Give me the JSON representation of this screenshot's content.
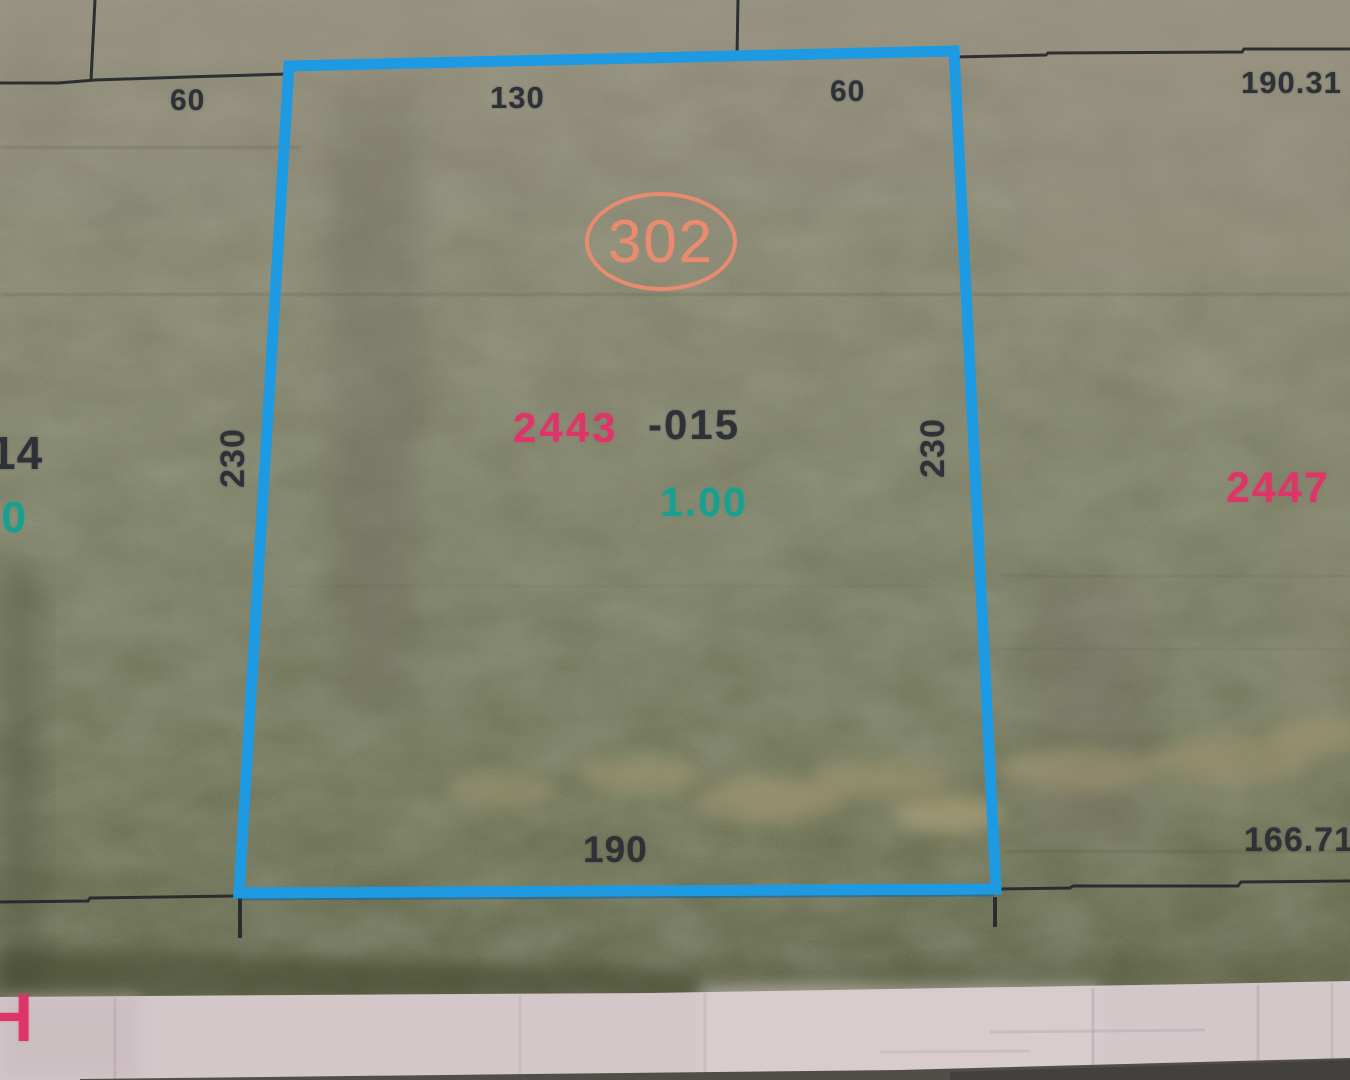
{
  "map": {
    "parcel": {
      "circle_number": "302",
      "book_id": "2443",
      "parcel_suffix": "-015",
      "acreage": "1.00",
      "dim_top": "130",
      "dim_left": "230",
      "dim_right": "230",
      "dim_bottom": "190"
    },
    "adjacent_labels": {
      "top_left_60": "60",
      "top_right_60": "60",
      "right_190_31": "190.31",
      "bottom_right_166_71": "166.71",
      "left_parcel_partial": "14",
      "left_acreage_partial": "00",
      "right_parcel_id": "2447",
      "bottom_left_partial": "H"
    },
    "colors": {
      "boundary_blue": "#1e9ae2",
      "circle_orange": "#e98b6e",
      "parcel_pink": "#dd3567",
      "acreage_teal": "#17a090",
      "dimension_text": "#2e3138"
    }
  }
}
